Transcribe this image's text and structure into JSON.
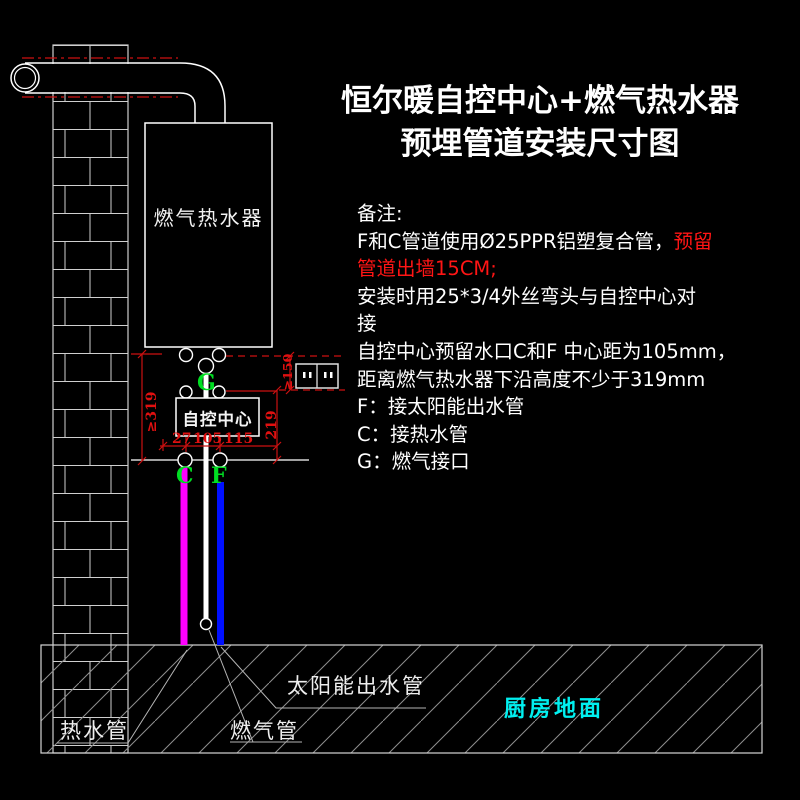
{
  "title": {
    "line1": "恒尔暖自控中心+燃气热水器",
    "line2": "预埋管道安装尺寸图"
  },
  "notes": {
    "heading": "备注:",
    "l1a": "F和C管道使用Ø25PPR铝塑复合管，",
    "l1b": "预留",
    "l2": "管道出墙15CM;",
    "l3": "安装时用25*3/4外丝弯头与自控中心对",
    "l4": "接",
    "l5": "自控中心预留水口C和F 中心距为105mm，",
    "l6": "距离燃气热水器下沿高度不少于319mm",
    "l7": "F：接太阳能出水管",
    "l8": "C：接热水管",
    "l9": "G：燃气接口"
  },
  "diagram": {
    "heater_label": "燃气热水器",
    "control_label": "自控中心",
    "ports": {
      "c": "C",
      "f": "F",
      "g": "G"
    },
    "dims": {
      "d319": "≥319",
      "d219": "219",
      "d150": "≥150",
      "d27": "27",
      "d105": "105",
      "d115": "115"
    },
    "labels": {
      "hot_water": "热水管",
      "gas": "燃气管",
      "solar": "太阳能出水管",
      "kitchen_floor": "厨房地面"
    }
  },
  "colors": {
    "background": "#000000",
    "line_white": "#ffffff",
    "dim_red": "#cc1111",
    "note_red": "#ff1515",
    "port_green": "#00dd22",
    "hot_water_pipe": "#ff00ff",
    "solar_pipe": "#0010ff",
    "kitchen_cyan": "#00f0f0"
  }
}
